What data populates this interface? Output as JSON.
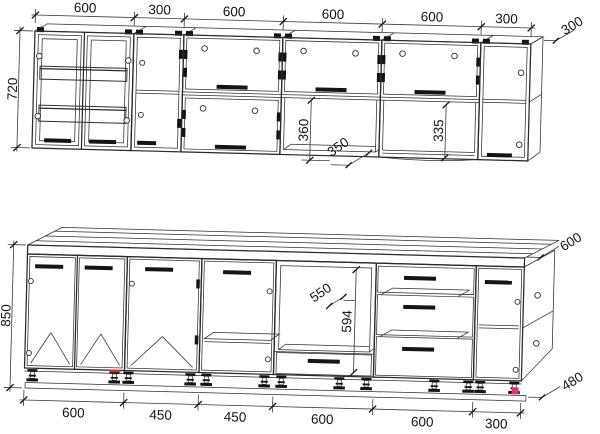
{
  "upper_row": {
    "section_widths": [
      "600",
      "300",
      "600",
      "600",
      "600",
      "300"
    ],
    "height": "720",
    "depth": "300",
    "flip_section_height": "360",
    "niche_depth": "350",
    "open_niche_height": "335"
  },
  "lower_row": {
    "section_widths": [
      "600",
      "450",
      "450",
      "600",
      "600",
      "300"
    ],
    "height": "850",
    "countertop_depth": "600",
    "carcass_depth": "480",
    "oven_niche_width": "550",
    "oven_niche_height": "594"
  },
  "marker_colors": {
    "red": "#d32a2a",
    "magenta": "#d93579"
  }
}
